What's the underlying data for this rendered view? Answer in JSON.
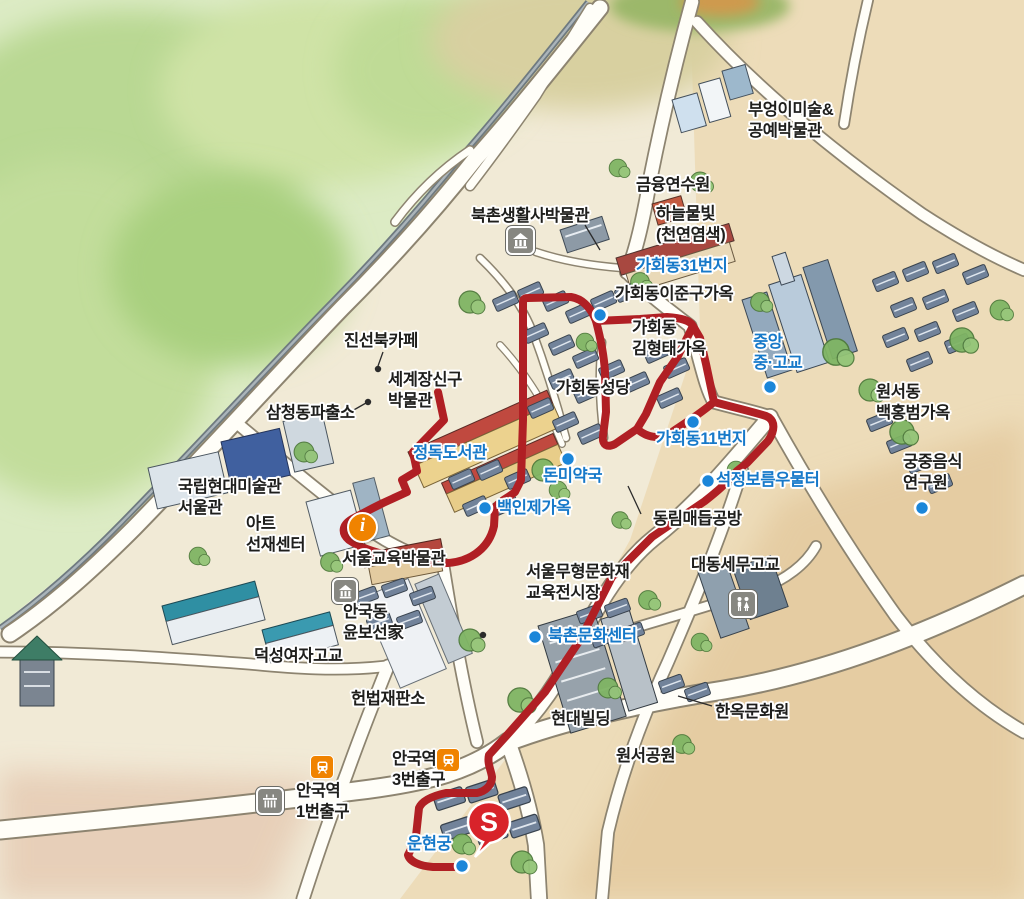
{
  "map_name": "Bukchon Hanok Village illustrated walking map",
  "palette": {
    "route": "#b01f24",
    "poi_blue": "#1779c9",
    "dot_fill": "#1b86d9",
    "accent_orange": "#f08300",
    "pin_red": "#d8232a",
    "road_fill": "#fffef8",
    "park_green": "#cfe3a8"
  },
  "start_marker": {
    "glyph": "S"
  },
  "info_marker": {
    "glyph": "i"
  },
  "icons": {
    "museum": "museum-icon (hanok house in grey rounded square)",
    "restroom": "restroom-icon (two figures in grey rounded square)",
    "palace": "palace-icon (palace gate in grey rounded square)",
    "subway": "subway-icon (train in orange rounded square)",
    "info": "info-icon (orange circle with i)",
    "start": "start-pin (red balloon with S)"
  },
  "labels": [
    {
      "text": "부엉이미술&\n공예박물관",
      "color": "black"
    },
    {
      "text": "금융연수원",
      "color": "black"
    },
    {
      "text": "하늘물빛\n(천연염색)",
      "color": "black"
    },
    {
      "text": "북촌생활사박물관",
      "color": "black"
    },
    {
      "text": "가회동31번지",
      "color": "blue"
    },
    {
      "text": "가회동이준구가옥",
      "color": "black"
    },
    {
      "text": "가회동\n김형태가옥",
      "color": "black"
    },
    {
      "text": "중앙\n중·고교",
      "color": "blue"
    },
    {
      "text": "진선북카페",
      "color": "black"
    },
    {
      "text": "세계장신구\n박물관",
      "color": "black"
    },
    {
      "text": "삼청동파출소",
      "color": "black"
    },
    {
      "text": "가회동성당",
      "color": "black"
    },
    {
      "text": "원서동\n백홍범가옥",
      "color": "black"
    },
    {
      "text": "정독도서관",
      "color": "blue"
    },
    {
      "text": "돈미약국",
      "color": "blue"
    },
    {
      "text": "가회동11번지",
      "color": "blue"
    },
    {
      "text": "궁중음식\n연구원",
      "color": "black"
    },
    {
      "text": "국립현대미술관\n서울관",
      "color": "black"
    },
    {
      "text": "백인제가옥",
      "color": "blue"
    },
    {
      "text": "석정보름우물터",
      "color": "blue"
    },
    {
      "text": "동림매듭공방",
      "color": "black"
    },
    {
      "text": "아트\n선재센터",
      "color": "black"
    },
    {
      "text": "서울교육박물관",
      "color": "black"
    },
    {
      "text": "서울무형문화재\n교육전시장",
      "color": "black"
    },
    {
      "text": "대동세무고교",
      "color": "black"
    },
    {
      "text": "안국동\n윤보선家",
      "color": "black"
    },
    {
      "text": "덕성여자고교",
      "color": "black"
    },
    {
      "text": "북촌문화센터",
      "color": "blue"
    },
    {
      "text": "헌법재판소",
      "color": "black"
    },
    {
      "text": "현대빌딩",
      "color": "black"
    },
    {
      "text": "한옥문화원",
      "color": "black"
    },
    {
      "text": "원서공원",
      "color": "black"
    },
    {
      "text": "안국역\n3번출구",
      "color": "black"
    },
    {
      "text": "안국역\n1번출구",
      "color": "black"
    },
    {
      "text": "운현궁",
      "color": "blue"
    }
  ]
}
